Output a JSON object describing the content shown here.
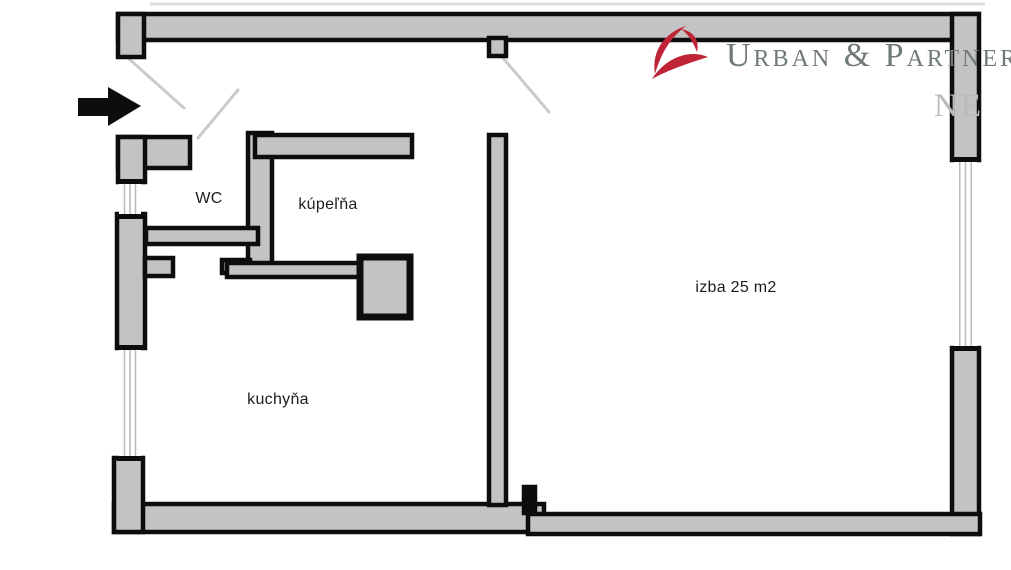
{
  "page": {
    "width": 1011,
    "height": 570,
    "background": "#ffffff"
  },
  "branding": {
    "logo_text": "Urban & Partneri",
    "logo_text_color": "#6f7979",
    "logo_icon_color": "#bf2436",
    "watermark_text": "NE",
    "watermark_color": "#b7bbbb"
  },
  "floorplan": {
    "wall_fill": "#c3c3c3",
    "wall_stroke": "#0d0d0d",
    "window_line_color": "#b9b9b9",
    "door_swing_color": "#cbcbcb",
    "rooms": [
      {
        "id": "wc",
        "label": "WC",
        "x": 209,
        "y": 199
      },
      {
        "id": "kupelna",
        "label": "kúpeľňa",
        "x": 328,
        "y": 205
      },
      {
        "id": "kuchyna",
        "label": "kuchyňa",
        "x": 278,
        "y": 400
      },
      {
        "id": "izba",
        "label": "izba 25 m2",
        "x": 736,
        "y": 288
      }
    ],
    "walls": [
      {
        "name": "top-wall",
        "x": 118,
        "y": 14,
        "w": 860,
        "h": 26
      },
      {
        "name": "top-wall-left-return",
        "x": 118,
        "y": 14,
        "w": 26,
        "h": 43
      },
      {
        "name": "izba-door-jamb-top",
        "x": 489,
        "y": 38,
        "w": 17,
        "h": 18
      },
      {
        "name": "right-wall-upper",
        "x": 952,
        "y": 14,
        "w": 27,
        "h": 146
      },
      {
        "name": "right-wall-lower",
        "x": 952,
        "y": 348,
        "w": 27,
        "h": 186
      },
      {
        "name": "bottom-wall-kitchen",
        "x": 114,
        "y": 504,
        "w": 430,
        "h": 28
      },
      {
        "name": "bottom-wall-izba",
        "x": 528,
        "y": 514,
        "w": 452,
        "h": 20
      },
      {
        "name": "bottom-left-corner",
        "x": 114,
        "y": 458,
        "w": 29,
        "h": 74
      },
      {
        "name": "left-wall-mid",
        "x": 117,
        "y": 214,
        "w": 28,
        "h": 134
      },
      {
        "name": "left-wall-stub",
        "x": 145,
        "y": 258,
        "w": 28,
        "h": 18
      },
      {
        "name": "left-top-wall-h",
        "x": 118,
        "y": 137,
        "w": 72,
        "h": 31
      },
      {
        "name": "left-top-wall-v",
        "x": 118,
        "y": 137,
        "w": 27,
        "h": 45
      },
      {
        "name": "wc-east-wall",
        "x": 248,
        "y": 133,
        "w": 24,
        "h": 140
      },
      {
        "name": "wc-east-wall-foot",
        "x": 222,
        "y": 260,
        "w": 28,
        "h": 13
      },
      {
        "name": "wc-south-wall",
        "x": 146,
        "y": 228,
        "w": 112,
        "h": 16
      },
      {
        "name": "kupelna-north-wall",
        "x": 255,
        "y": 135,
        "w": 157,
        "h": 22
      },
      {
        "name": "kupelna-south-wall",
        "x": 227,
        "y": 263,
        "w": 137,
        "h": 14
      },
      {
        "name": "shaft",
        "x": 360,
        "y": 257,
        "w": 50,
        "h": 60,
        "thick": true
      },
      {
        "name": "central-wall",
        "x": 489,
        "y": 135,
        "w": 17,
        "h": 370
      },
      {
        "name": "central-wall-jamb",
        "x": 524,
        "y": 487,
        "w": 11,
        "h": 26,
        "solid": true
      }
    ],
    "windows": [
      {
        "name": "window-left-upper",
        "x": 119,
        "y": 182,
        "w": 22,
        "h": 34
      },
      {
        "name": "window-left-lower",
        "x": 119,
        "y": 348,
        "w": 22,
        "h": 110
      },
      {
        "name": "window-right",
        "x": 954,
        "y": 160,
        "w": 23,
        "h": 188
      }
    ],
    "door_swings": [
      {
        "name": "entry-door-swing-left",
        "x1": 128,
        "y1": 58,
        "x2": 184,
        "y2": 108
      },
      {
        "name": "entry-door-swing-right",
        "x1": 238,
        "y1": 90,
        "x2": 198,
        "y2": 138
      },
      {
        "name": "izba-door-swing",
        "x1": 503,
        "y1": 58,
        "x2": 549,
        "y2": 112
      }
    ],
    "entry_arrow": {
      "points": "78,98 108,98 108,87 141,106 108,126 108,116 78,116"
    },
    "faint_lines": [
      {
        "name": "scan-artifact-line",
        "x1": 150,
        "y1": 4,
        "x2": 985,
        "y2": 4,
        "color": "#dcdcdc"
      }
    ]
  }
}
